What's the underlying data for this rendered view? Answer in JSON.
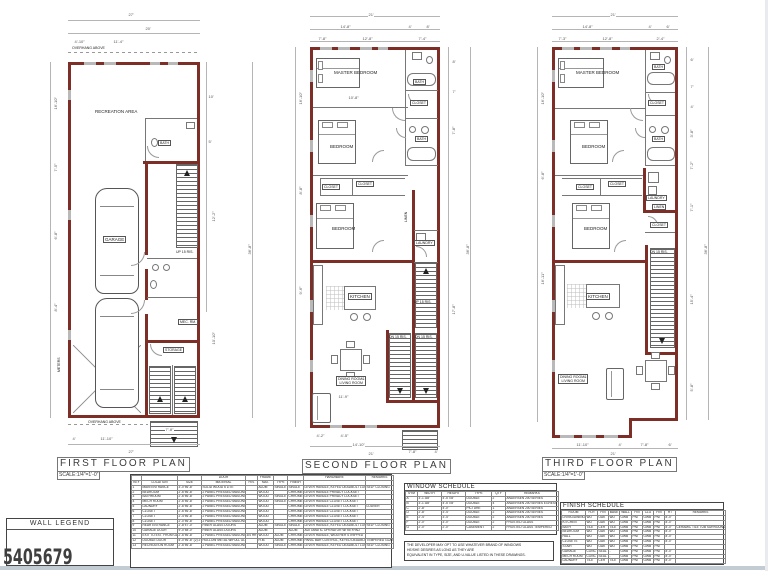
{
  "colors": {
    "wall": "#7c2e27",
    "legend_wall": "#ffffff",
    "legend_fire": "#7c2e27",
    "legend_brick": "#989898",
    "legend_nc": "#4a4a4a",
    "watermark": "#3f3f3f"
  },
  "watermark": "5405679",
  "plans": {
    "first": {
      "title": "FIRST FLOOR PLAN",
      "scale": "SCALE:1/4\"=1'-0\"",
      "rooms": {
        "recreation": "RECREATION AREA",
        "bath": "BATH",
        "garage": "GARAGE",
        "mech": "MEC. RM.",
        "storage": "STORAGE",
        "meters": "METERS",
        "overhang_top": "OVERHANG ABOVE",
        "overhang_bottom": "OVERHANG ABOVE"
      },
      "stairs": {
        "up": "UP 15 RIS."
      },
      "dims": {
        "top_total": "27'",
        "top_a": "20'",
        "top_b": "4'-10\"",
        "top_c": "11'-4\"",
        "left_a": "16'-10\"",
        "left_b": "7'-5\"",
        "left_c": "6'-8\"",
        "left_d": "8'-4\"",
        "right_a": "10'",
        "right_b": "5'",
        "right_c": "12'-2\"",
        "right_d": "10'-10\"",
        "right_total": "36'-8\"",
        "bottom_a": "4'",
        "bottom_b": "11'-10\"",
        "bottom_total": "27'",
        "stair": "7'-8\""
      }
    },
    "second": {
      "title": "SECOND FLOOR PLAN",
      "scale": "SCALE:1/4\"=1'-0\"",
      "rooms": {
        "master": "MASTER BEDROOM",
        "bath1": "BATH",
        "closet1": "CLOSET",
        "bedroom1": "BEDROOM",
        "bath2": "BATH",
        "closet2": "CLOSET",
        "closet3": "CLOSET",
        "bedroom2": "BEDROOM",
        "linen": "LINEN",
        "laundry": "LAUNDRY",
        "kitchen": "KITCHEN",
        "dining1": "DINING ROOM&",
        "dining2": "LIVING ROOM"
      },
      "stairs": {
        "up": "UP 15 RIS.",
        "dn1": "DN 15 RIS.",
        "dn2": "DN 15 RIS."
      },
      "dims": {
        "top_total": "21'",
        "top_a": "14'-8\"",
        "top_b": "4'",
        "top_c": "8'",
        "top_d": "7'-8\"",
        "top_e": "12'-8\"",
        "top_f": "7'-4\"",
        "left_a": "16'-10\"",
        "left_b": "8'-8\"",
        "left_c": "9'-6\"",
        "right_a": "8'",
        "right_b": "7'",
        "right_c": "7'-8\"",
        "right_d": "17'-8\"",
        "right_total": "36'-8\"",
        "mid": "10'-8\"",
        "bottom_a": "11'-9\"",
        "bottom_b": "4'-2\"",
        "bottom_c": "4'-5\"",
        "bottom_d": "14'-10\"",
        "bottom_e": "7'-8\"",
        "bottom_f": "4'",
        "bottom_total": "21'"
      }
    },
    "third": {
      "title": "THIRD FLOOR PLAN",
      "scale": "SCALE:1/4\"=1'-0\"",
      "rooms": {
        "master": "MASTER BEDROOM",
        "bath1": "BATH",
        "closet1": "CLOSET",
        "bedroom1": "BEDROOM",
        "bath2": "BATH",
        "laundry": "LAUNDRY",
        "linen": "LINEN",
        "closet2": "CLOSET",
        "closet3": "CLOSET",
        "closet4": "CLOSET",
        "bedroom2": "BEDROOM",
        "kitchen": "KITCHEN",
        "dining1": "DINING ROOM&",
        "dining2": "LIVING ROOM"
      },
      "stairs": {
        "dn": "DN 15 RIS."
      },
      "dims": {
        "top_total": "21'",
        "top_a": "14'-8\"",
        "top_b": "4'",
        "top_c": "6'",
        "top_d": "7'-3\"",
        "top_e": "12'-8\"",
        "top_f": "2'-4\"",
        "left_a": "16'-10\"",
        "left_b": "6'-8\"",
        "left_c": "16'-11\"",
        "right_a": "6'",
        "right_b": "7'",
        "right_c": "4'",
        "right_d": "3'-8\"",
        "right_e": "7'-2\"",
        "right_f": "7'-1\"",
        "right_g": "15'-4\"",
        "right_h": "5'-8\"",
        "right_total": "36'-8\"",
        "bottom_a": "11'-10\"",
        "bottom_b": "4'",
        "bottom_c": "7'-8\"",
        "bottom_d": "6'",
        "bottom_total": "21'"
      }
    }
  },
  "wall_legend": {
    "title": "WALL LEGEND",
    "items": [
      {
        "label": "WALL"
      },
      {
        "label": "1 HR. FIREWALL"
      },
      {
        "label": "BRICK"
      },
      {
        "label": "NC RATED"
      }
    ]
  },
  "door_schedule": {
    "header_rows": [
      [
        "",
        "",
        "",
        "DOOR",
        "",
        "FRAME",
        "",
        "",
        "HARDWARE",
        "REMARKS"
      ],
      [
        "KEY",
        "LOCATION",
        "SIZE",
        "MATERIAL",
        "FIN.",
        "MAT.",
        "TYPE",
        "FINISH",
        "",
        ""
      ]
    ],
    "rows": [
      [
        "1",
        "MAIN ENTRANCE",
        "3'-0\"x6'-8\"",
        "SOLID WOOD 6 LITE",
        "",
        "ALUM",
        "SINGLE",
        "SINGLE",
        "LEVER HANDLE, KEYED DEADBOLT LOCKSET",
        "SELF CLOSING"
      ],
      [
        "2",
        "BEDROOM",
        "2'-6\"x6'-8\"",
        "2 PANEL PRESSED MASONITE",
        "",
        "WOOD",
        "",
        "CHROME",
        "LEVER HANDLE PRIVACY LOCKSET",
        ""
      ],
      [
        "3",
        "BATHROOM",
        "2'-6\"x6'-8\"",
        "2 PANEL PRESSED MASONITE",
        "",
        "WOOD",
        "SINGLE",
        "CHROME",
        "LEVER HANDLE PRIVACY LOCKSET",
        ""
      ],
      [
        "4",
        "MECH ROOM",
        "2'-6\"x6'-8\"",
        "2 PANEL PRESSED MASONITE",
        "",
        "WOOD",
        "SINGLE",
        "CHROME",
        "LEVER HANDLE CLOSET LOCKSET",
        ""
      ],
      [
        "5",
        "LAUNDRY",
        "2'-6\"x6'-8\"",
        "2 PANEL PRESSED MASONITE",
        "",
        "WOOD",
        "",
        "CHROME",
        "LEVER HANDLE CLOSET LOCKSET",
        "LOUVER"
      ],
      [
        "6",
        "CLOSET",
        "2'-6\"x6'-8\"",
        "2 PANEL PRESSED MASONITE",
        "",
        "WOOD",
        "",
        "CHROME",
        "LEVER HANDLE CLOSET LOCKSET",
        ""
      ],
      [
        "7",
        "CLOSET",
        "2'-4\"x6'-8\"",
        "2 PANEL PRESSED MASONITE",
        "",
        "WOOD",
        "",
        "CHROME",
        "LEVER HANDLE CLOSET LOCKSET",
        ""
      ],
      [
        "8",
        "CLOSET",
        "2'-0\"x6'-8\"",
        "2 PANEL PRESSED MASONITE",
        "",
        "WOOD",
        "",
        "CHROME",
        "LEVER HANDLE CLOSET LOCKSET",
        ""
      ],
      [
        "9",
        "REAR ENTRANCE",
        "2'-8\"x7'-0\"",
        "FIBER GLASS DOORS",
        "",
        "ALUM",
        "SINGLE",
        "SINGLE",
        "LEVER HANDLE, KEYED DEADBOLT LOCKSET",
        "SELF CLOSING"
      ],
      [
        "10",
        "GARAGE DOOR",
        "9'-0\"x8'-0\"",
        "FIBER GLASS DOORS",
        "",
        "ALUM",
        "",
        "ALUM",
        "AUTOMATIC OPERATOR W/ KEYPAD",
        ""
      ],
      [
        "11",
        "EXIT TO EXT. FROM GARAGE",
        "2'-6\"x6'-8\"",
        "2 PANEL PRESSED MASONITE",
        "3/4 HR",
        "WOOD",
        "ALUM",
        "CHROME",
        "LEVER HANDLE, WEATHER STRIPPED",
        ""
      ],
      [
        "12",
        "DOUBLE DOOR",
        "5'-0\"x6'-8\" (2) 2'-6\"",
        "HOLLOW METAL W/FULL GLASS",
        "",
        "H.M.",
        "ALUM",
        "CHROME",
        "PANIC BAR CONTROL, KEYED DEADBOLT LOCKSET",
        "TEMPERED GLASS"
      ],
      [
        "13",
        "RECREATION ROOM",
        "2'-6\"x6'-8\"",
        "2 PANEL PRESSED MASONITE",
        "",
        "WOOD",
        "SINGLE",
        "CHROME",
        "LEVER HANDLE, KEYED DEADBOLT LOCKSET",
        "SELF CLOSING"
      ]
    ]
  },
  "window_schedule": {
    "title": "WINDOW SCHEDULE",
    "header_rows": [
      [
        "SYM",
        "WIDTH",
        "HEIGHT",
        "TYPE",
        "QTY",
        "REMARKS"
      ]
    ],
    "rows": [
      [
        "A",
        "3'-1 3/8\"",
        "4'-5 7/8\"",
        "DOUBLE",
        "2",
        "ANDERSEN 200 SERIES"
      ],
      [
        "B",
        "3'-1 3/8\"",
        "4'-5 7/8\"",
        "DOUBLE",
        "4",
        "ANDERSEN 200 SERIES EGRESS WINDOW MIN 5.7 SQ.FT."
      ],
      [
        "C",
        "2'-8\"",
        "4'-0\"",
        "PICTURE",
        "1",
        "ANDERSEN 200 SERIES"
      ],
      [
        "D",
        "2'-8\"",
        "3'-4\"",
        "DOUBLE",
        "2",
        "ANDERSEN 200 SERIES"
      ],
      [
        "E",
        "2'-4\"",
        "3'-4\"",
        "DOUBLE",
        "2",
        "ANDERSEN 200 SERIES"
      ],
      [
        "F",
        "2'-0\"",
        "3'-0\"",
        "DOUBLE",
        "2",
        "FROSTED GLASS"
      ],
      [
        "G",
        "2'-0\"",
        "2'-0\"",
        "CASEMENT",
        "2",
        "FROSTED GLASS TEMPERED"
      ]
    ],
    "note_lines": [
      "THE DEVELOPER MAY OPT TO USE WHATEVER BRAND OF WINDOWS",
      "HE/SHE DESIRES AS LONG AS THEY ARE",
      "EQUIVALENT IN TYPE, SIZE, AND U-VALUE LISTED IN THESE DRAWINGS."
    ]
  },
  "finish_schedule": {
    "title": "FINISH SCHEDULE",
    "header_rows": [
      [
        "ROOM",
        "FLR",
        "FIN",
        "BASE",
        "WALL",
        "FIN",
        "CLG",
        "FIN",
        "HT",
        "REMARKS"
      ]
    ],
    "rows": [
      [
        "LIVING/DINING",
        "WD",
        "OAK",
        "WD",
        "GWB",
        "PNT",
        "GWB",
        "PNT",
        "8'-0\"",
        ""
      ],
      [
        "KITCHEN",
        "WD",
        "OAK",
        "WD",
        "GWB",
        "PNT",
        "GWB",
        "PNT",
        "8'-0\"",
        ""
      ],
      [
        "BATH",
        "TILE",
        "CER",
        "TILE",
        "GWB",
        "PNT",
        "GWB",
        "PNT",
        "8'-0\"",
        "CERAMIC TILE TUB SURROUND TO 6'-0\" A.F.F."
      ],
      [
        "BEDROOM",
        "WD",
        "OAK",
        "WD",
        "GWB",
        "PNT",
        "GWB",
        "PNT",
        "8'-0\"",
        ""
      ],
      [
        "HALL",
        "WD",
        "OAK",
        "WD",
        "GWB",
        "PNT",
        "GWB",
        "PNT",
        "8'-0\"",
        ""
      ],
      [
        "CLOSETS",
        "WD",
        "OAK",
        "WD",
        "GWB",
        "PNT",
        "GWB",
        "PNT",
        "8'-0\"",
        ""
      ],
      [
        "STAIR",
        "WD",
        "OAK",
        "WD",
        "GWB",
        "PNT",
        "GWB",
        "PNT",
        "",
        ""
      ],
      [
        "GARAGE",
        "CONC",
        "SEAL",
        "-",
        "GWB",
        "PNT",
        "GWB",
        "PNT",
        "8'-0\"",
        ""
      ],
      [
        "MECH ROOM",
        "CONC",
        "SEAL",
        "-",
        "GWB",
        "PNT",
        "GWB",
        "PNT",
        "8'-0\"",
        ""
      ],
      [
        "LAUNDRY",
        "TILE",
        "CER",
        "TILE",
        "GWB",
        "PNT",
        "GWB",
        "PNT",
        "8'-0\"",
        ""
      ]
    ]
  }
}
